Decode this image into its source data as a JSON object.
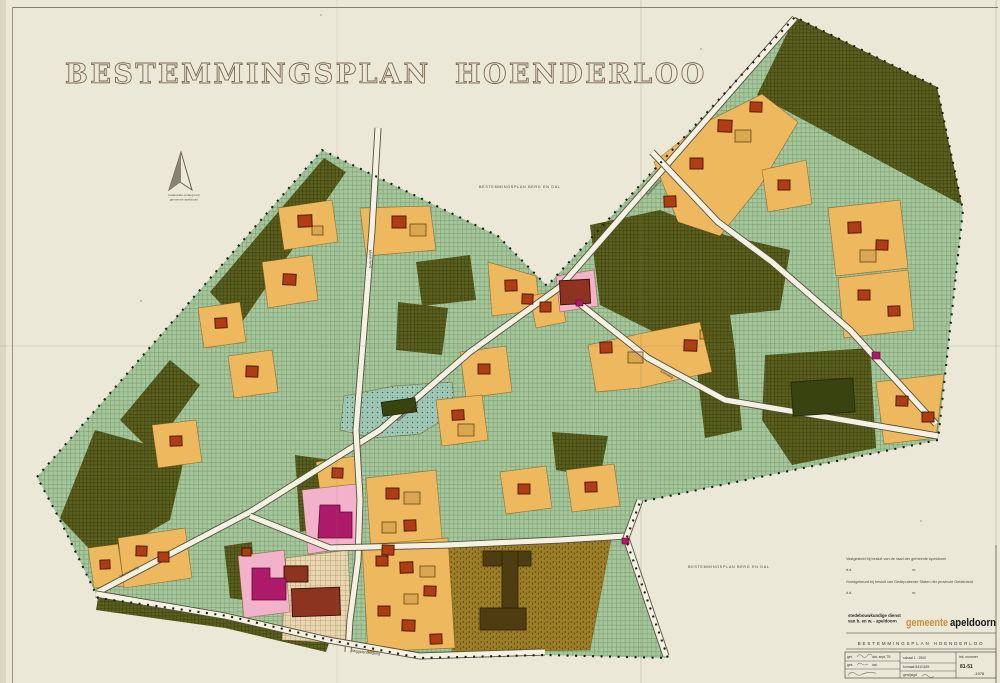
{
  "page": {
    "title1": "BESTEMMINGSPLAN",
    "title2": "HOENDERLOO"
  },
  "north": {
    "cap1": "kadastrale ondergrond",
    "cap2": "gemeente apeldoorn"
  },
  "adjacent": {
    "top": "BESTEMMINGSPLAN  BERG EN DAL",
    "bottom": "BESTEMMINGSPLAN  BERG EN DAL"
  },
  "approval": {
    "line1": "Vastgesteld bij besluit van de raad der gemeente Apeldoorn",
    "line2_dd": "d.d.",
    "line2_nr": "nr.",
    "line3": "Goedgekeurd bij besluit van Gedeputeerde Staten der provincie Gelderland",
    "line4_dd": "d.d.",
    "line4_nr": "nr."
  },
  "stamp": {
    "dept1": "stedebouwkundige dienst",
    "dept2": "van b. en w. - apeldoorn",
    "muni1": "gemeente",
    "muni2": "apeldoorn",
    "plan": "BESTEMMINGSPLAN  HOENDERLOO",
    "get": "get.",
    "get_dat": "dat. sept.'76",
    "gez": "gez.",
    "gez_dat": "dat.",
    "schaal": "schaal 1 : 2500",
    "formaat": "formaat 841/1189",
    "gewijzigd": "gewijzigd",
    "teknr_label": "tek. nummer",
    "teknr": "81-51",
    "jaar": "-1976"
  },
  "colors": {
    "paper": "#ece8d8",
    "parcel": "#edb85e",
    "parcel_edge": "rgba(104,70,12,0.55)",
    "pink": "#f2b3ca",
    "magenta": "#ae1a6a",
    "building": "#b03c14",
    "big_building": "#8c3420",
    "dark_building": "#39430f",
    "i_building": "#4e3d10",
    "road": "#f4f1e3",
    "road_edge": "#56503c"
  },
  "map": {
    "region": "37,477 322,150 498,236 547,286 795,17 937,87 963,210 938,440 640,502 626,540 668,658 545,655 420,658 330,640 228,616 98,598 60,520",
    "dark_areas": [
      "795,17 937,87 962,205 757,95",
      "590,225 660,210 725,235 790,250 780,310 730,315 735,350 695,355 650,330 600,305",
      "695,355 735,350 742,430 705,438",
      "765,355 870,348 876,448 792,465 762,420",
      "210,292 324,158 346,172 240,325",
      "120,420 170,360 200,385 152,452",
      "60,518 95,430 185,455 170,520 100,560",
      "295,455 345,462 340,525 300,532",
      "98,598 230,616 330,640 326,652 225,628 96,610",
      "398,302 448,308 442,355 396,350",
      "552,432 608,436 600,478 556,470",
      "224,546 252,542 256,602 230,598",
      "416,262 470,255 476,300 422,306"
    ],
    "teal_areas": [
      "340,430 344,396 394,386 452,382 456,412 420,434 374,438"
    ],
    "brown_areas": [
      "448,543 612,534 590,650 452,652"
    ],
    "beige_areas": [
      "286,558 348,550 352,644 282,640"
    ],
    "orange_parcels": [
      "278,208 332,200 338,242 284,250",
      "262,262 312,255 318,300 268,308",
      "198,308 240,302 246,342 204,348",
      "228,356 272,350 278,392 234,398",
      "152,425 196,420 202,462 158,468",
      "360,208 430,206 436,250 366,256",
      "488,262 536,276 540,310 492,316",
      "460,352 506,346 512,392 466,398",
      "436,400 482,395 488,440 442,446",
      "316,462 356,456 360,486 320,492",
      "366,478 436,470 444,560 372,566",
      "500,472 546,466 552,508 506,514",
      "566,470 614,464 620,506 572,512",
      "118,538 185,528 192,578 124,588",
      "88,548 118,544 124,586 94,588",
      "362,545 448,538 455,648 368,652",
      "654,162 702,124 762,94 798,122 760,186 720,236 678,222",
      "762,170 806,160 812,204 768,212",
      "828,208 900,200 908,268 836,276",
      "838,278 908,270 914,330 844,338",
      "876,382 944,374 936,438 884,444",
      "588,345 648,332 700,322 712,372 640,388 596,392",
      "530,296 560,290 566,322 536,328"
    ],
    "pink_areas": [
      "302,490 356,484 362,546 308,554",
      "238,556 284,550 290,612 244,618",
      "556,276 594,270 598,306 560,312"
    ],
    "roads": [
      "795,18 560,287",
      "560,287 470,352 380,430 250,512 98,592",
      "565,292 648,358 725,400 938,436",
      "652,152 718,222 772,262 850,330 936,424",
      "378,128 372,230 364,330 356,430 360,500 358,560 350,620 348,652",
      "250,516 330,548 448,545 560,540 626,536",
      "96,594 225,616 328,640 420,656 545,652",
      "640,500 626,538 666,656"
    ],
    "envelopes": [
      [
        312,
        226,
        11,
        9
      ],
      [
        410,
        224,
        16,
        12
      ],
      [
        735,
        130,
        16,
        12
      ],
      [
        860,
        250,
        16,
        12
      ],
      [
        628,
        352,
        15,
        11
      ],
      [
        700,
        330,
        12,
        9
      ],
      [
        404,
        492,
        16,
        12
      ],
      [
        382,
        522,
        14,
        11
      ],
      [
        458,
        424,
        16,
        12
      ],
      [
        420,
        566,
        15,
        11
      ],
      [
        404,
        594,
        14,
        10
      ]
    ],
    "buildings": [
      [
        298,
        215,
        14,
        12,
        -2
      ],
      [
        283,
        274,
        13,
        11,
        3
      ],
      [
        215,
        318,
        12,
        10,
        -3
      ],
      [
        246,
        366,
        12,
        11,
        2
      ],
      [
        170,
        436,
        12,
        10,
        -2
      ],
      [
        392,
        216,
        14,
        12,
        0
      ],
      [
        505,
        280,
        12,
        11,
        -2
      ],
      [
        522,
        294,
        11,
        10,
        2
      ],
      [
        478,
        364,
        12,
        10,
        0
      ],
      [
        452,
        410,
        12,
        10,
        -3
      ],
      [
        332,
        468,
        11,
        10,
        2
      ],
      [
        386,
        488,
        13,
        11,
        0
      ],
      [
        404,
        520,
        12,
        11,
        -2
      ],
      [
        382,
        545,
        12,
        10,
        2
      ],
      [
        518,
        484,
        12,
        10,
        0
      ],
      [
        585,
        482,
        12,
        10,
        -2
      ],
      [
        136,
        546,
        11,
        10,
        2
      ],
      [
        158,
        552,
        11,
        10,
        0
      ],
      [
        100,
        560,
        10,
        9,
        -2
      ],
      [
        242,
        548,
        9,
        8,
        0
      ],
      [
        376,
        556,
        12,
        10,
        0
      ],
      [
        400,
        562,
        13,
        11,
        -2
      ],
      [
        424,
        586,
        12,
        10,
        2
      ],
      [
        378,
        606,
        12,
        10,
        0
      ],
      [
        402,
        620,
        13,
        11,
        2
      ],
      [
        430,
        634,
        12,
        10,
        -2
      ],
      [
        718,
        120,
        14,
        12,
        2
      ],
      [
        690,
        158,
        13,
        11,
        0
      ],
      [
        664,
        196,
        12,
        11,
        -2
      ],
      [
        750,
        102,
        12,
        10,
        2
      ],
      [
        778,
        180,
        12,
        10,
        0
      ],
      [
        848,
        222,
        13,
        11,
        -2
      ],
      [
        876,
        240,
        12,
        10,
        2
      ],
      [
        858,
        290,
        12,
        10,
        0
      ],
      [
        888,
        306,
        12,
        10,
        -2
      ],
      [
        896,
        396,
        12,
        10,
        2
      ],
      [
        922,
        412,
        12,
        10,
        0
      ],
      [
        600,
        342,
        12,
        11,
        -2
      ],
      [
        684,
        340,
        13,
        11,
        2
      ],
      [
        540,
        302,
        11,
        10,
        0
      ]
    ],
    "dark_buildings": [
      [
        792,
        380,
        62,
        34,
        -4
      ],
      [
        382,
        400,
        34,
        14,
        -8
      ]
    ],
    "red_buildings": [
      [
        560,
        280,
        30,
        24,
        -3
      ],
      [
        292,
        588,
        48,
        28,
        -2
      ],
      [
        284,
        566,
        24,
        16,
        0
      ]
    ],
    "i_building": [
      [
        483,
        551,
        48,
        15
      ],
      [
        502,
        551,
        16,
        70
      ],
      [
        480,
        608,
        46,
        22
      ]
    ],
    "magenta_polys": [
      "320,505 340,505 340,512 352,512 352,538 318,538",
      "252,568 270,568 270,578 286,578 286,600 252,600"
    ],
    "magenta_small": [
      [
        872,
        352,
        8,
        7
      ],
      [
        622,
        538,
        7,
        6
      ],
      [
        576,
        300,
        7,
        6
      ]
    ],
    "road_labels": [
      {
        "t": "Krimweg",
        "x": 660,
        "y": 372,
        "r": 28
      },
      {
        "t": "Middenweg",
        "x": 369,
        "y": 250,
        "r": 88
      },
      {
        "t": "Apeldoornseweg",
        "x": 398,
        "y": 422,
        "r": -41
      },
      {
        "t": "Delenseweg",
        "x": 648,
        "y": 196,
        "r": -49
      },
      {
        "t": "Otterloseweg",
        "x": 120,
        "y": 578,
        "r": -28
      },
      {
        "t": "Miggelenbergweg",
        "x": 352,
        "y": 652,
        "r": 6
      }
    ]
  }
}
